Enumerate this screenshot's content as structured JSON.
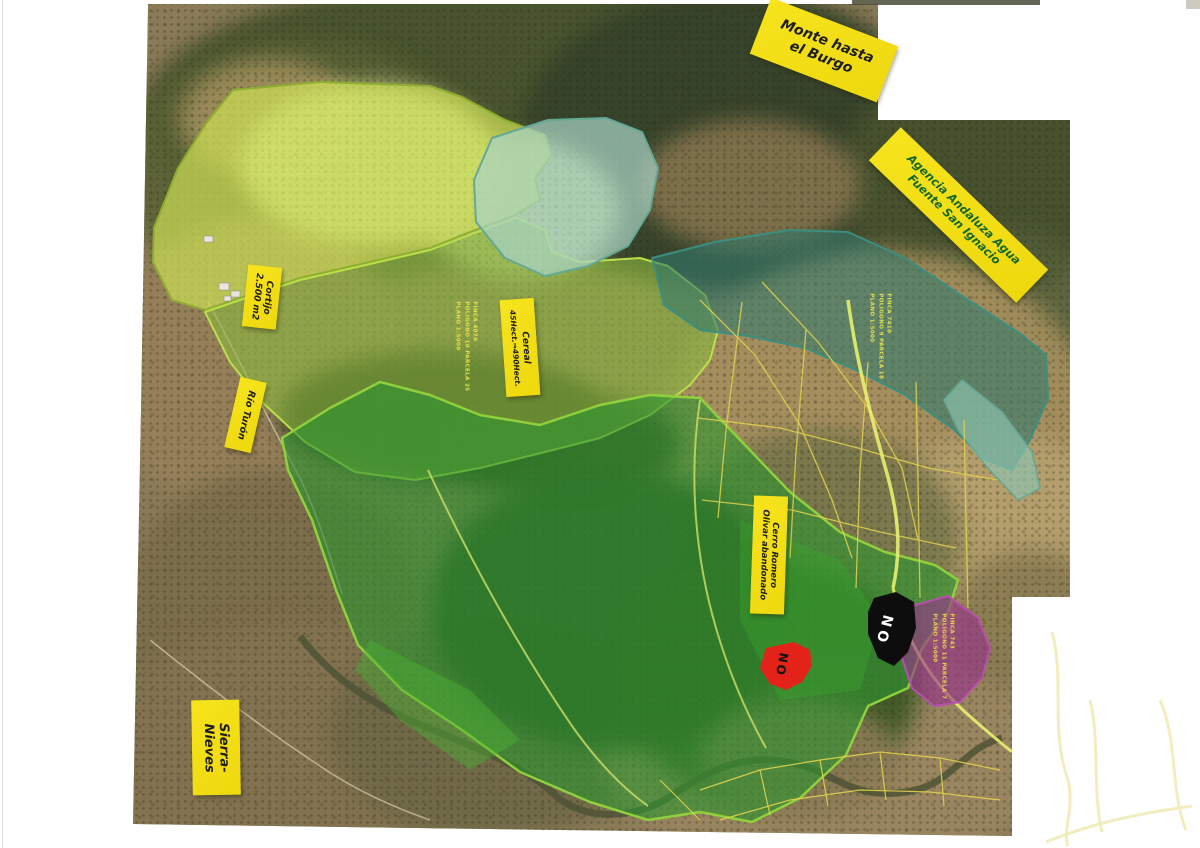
{
  "document": {
    "kind": "scanned aerial ortho-photo collage with hand-written land annotations",
    "background_color": "#ffffff"
  },
  "sticky_notes": {
    "monte_burgo": {
      "lines": [
        "Monte hasta",
        "el Burgo"
      ],
      "ink_color": "#1e1e1e"
    },
    "agencia_andaluza": {
      "lines": [
        "Agencia Andaluza Agua",
        "Fuente San Ignacio"
      ],
      "ink_color": "#17682c"
    },
    "cortijo": {
      "lines": [
        "Cortijo",
        "2.500 m2"
      ],
      "ink_color": "#1e1e1e"
    },
    "cereal": {
      "lines": [
        "Cereal",
        "45Hect.⇒490Hect."
      ],
      "ink_color": "#1e1e1e"
    },
    "rio_turon": {
      "lines": [
        "Río Turón"
      ],
      "ink_color": "#1e1e1e"
    },
    "cerro_romero": {
      "lines": [
        "Cerro Romero",
        "Olivar abandonado"
      ],
      "ink_color": "#1e1e1e"
    },
    "sierra_nieves": {
      "lines": [
        "Sierra-",
        "Nieves"
      ],
      "ink_color": "#1e1e1e"
    }
  },
  "markers": {
    "no_black": {
      "text": "NO",
      "bg_color": "#0d0d0d",
      "ink_color": "#ffffff"
    },
    "no_red": {
      "text": "NO",
      "bg_color": "#e3231a",
      "ink_color": "#111111"
    }
  },
  "parcel_texts": {
    "green": {
      "approx_lines": [
        "FINCA 4070",
        "POLIGONO 10 PARCELA 25",
        "PLANO 1:5000"
      ],
      "color": "#e6e14e"
    },
    "teal": {
      "approx_lines": [
        "FINCA 7410",
        "POLIGONO 9 PARCELA 18",
        "PLANO 1:5000"
      ],
      "color": "#e6e14e"
    },
    "purple": {
      "approx_lines": [
        "FINCA 743",
        "POLIGONO 11 PARCELA 7",
        "PLANO 1:5000"
      ],
      "color": "#e8d44e"
    }
  },
  "regions": [
    {
      "id": "pasture-light-green",
      "label": "Cortijo pasture (light yellow-green highlight)",
      "color": "#cadd55"
    },
    {
      "id": "cereal-medium-green",
      "label": "Cereal 45Hect (medium green highlight)",
      "color": "#8cb93f"
    },
    {
      "id": "forest-dark-green",
      "label": "Cerro Romero / Olivar abandonado (dark green highlight)",
      "color": "#2e9430"
    },
    {
      "id": "teal-north",
      "label": "Light teal highlighted valley (north)",
      "color": "#a9d4c6"
    },
    {
      "id": "teal-east",
      "label": "Agencia Andaluza Agua / Fuente San Ignacio band (teal)",
      "color": "#33796d"
    },
    {
      "id": "purple-parcel",
      "label": "Finca 743 parcel (purple highlight)",
      "color": "#96308b"
    }
  ],
  "colors": {
    "sticky_yellow": "#f5e21a",
    "cadastral_line_yellow": "#e3d44e",
    "road_highlight": "#e8ef6f",
    "river_dark_olive": "#4d5435"
  }
}
